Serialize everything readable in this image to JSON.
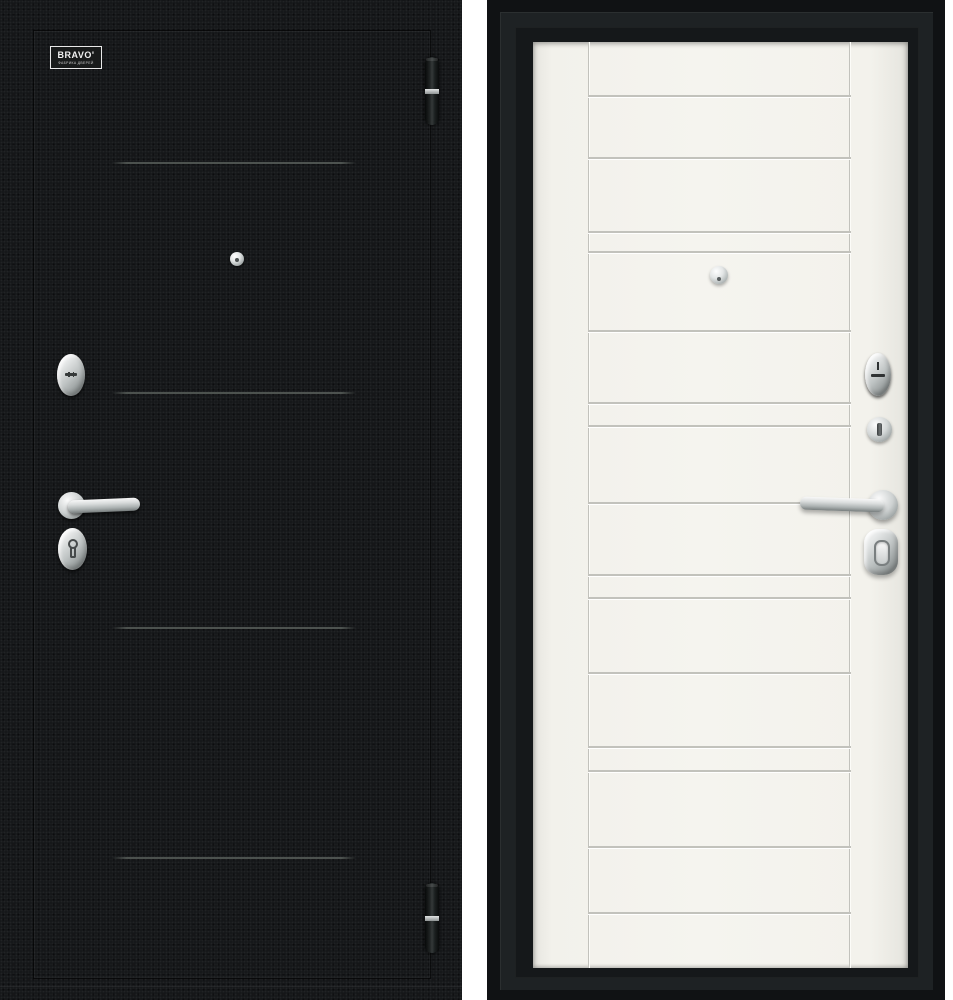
{
  "meta": {
    "description": "Product photo of a steel entry door: exterior black panel (left) and interior off-white panel (right)",
    "background_color": "#ffffff"
  },
  "exterior_door": {
    "panel_color": "#141618",
    "decor_line_color": "#565c58",
    "logo": {
      "brand": "BRAVO'",
      "tagline": "ФАБРИКА ДВЕРЕЙ"
    },
    "decor_lines_y": [
      163,
      393,
      628,
      858
    ],
    "hinges": [
      {
        "top": 57,
        "height": 68
      },
      {
        "top": 883,
        "height": 70
      }
    ],
    "hardware": [
      "peephole",
      "lock-cylinder",
      "lever-handle",
      "keyhole-escutcheon",
      "hinge-top",
      "hinge-bottom"
    ]
  },
  "interior_door": {
    "leaf_color": "#f3f2ec",
    "groove_color": "#c2c2bc",
    "frame_color": "#15181a",
    "leaf": {
      "x": 533,
      "y": 42,
      "width": 375,
      "height": 926
    },
    "stiles_x": [
      588,
      849
    ],
    "grooves_y": [
      96,
      158,
      232,
      252,
      331,
      403,
      426,
      503,
      575,
      598,
      673,
      747,
      771,
      847,
      913
    ],
    "hardware": [
      "peephole",
      "lock-cylinder",
      "night-latch-thumbturn",
      "lever-handle",
      "thumbturn-escutcheon"
    ]
  }
}
